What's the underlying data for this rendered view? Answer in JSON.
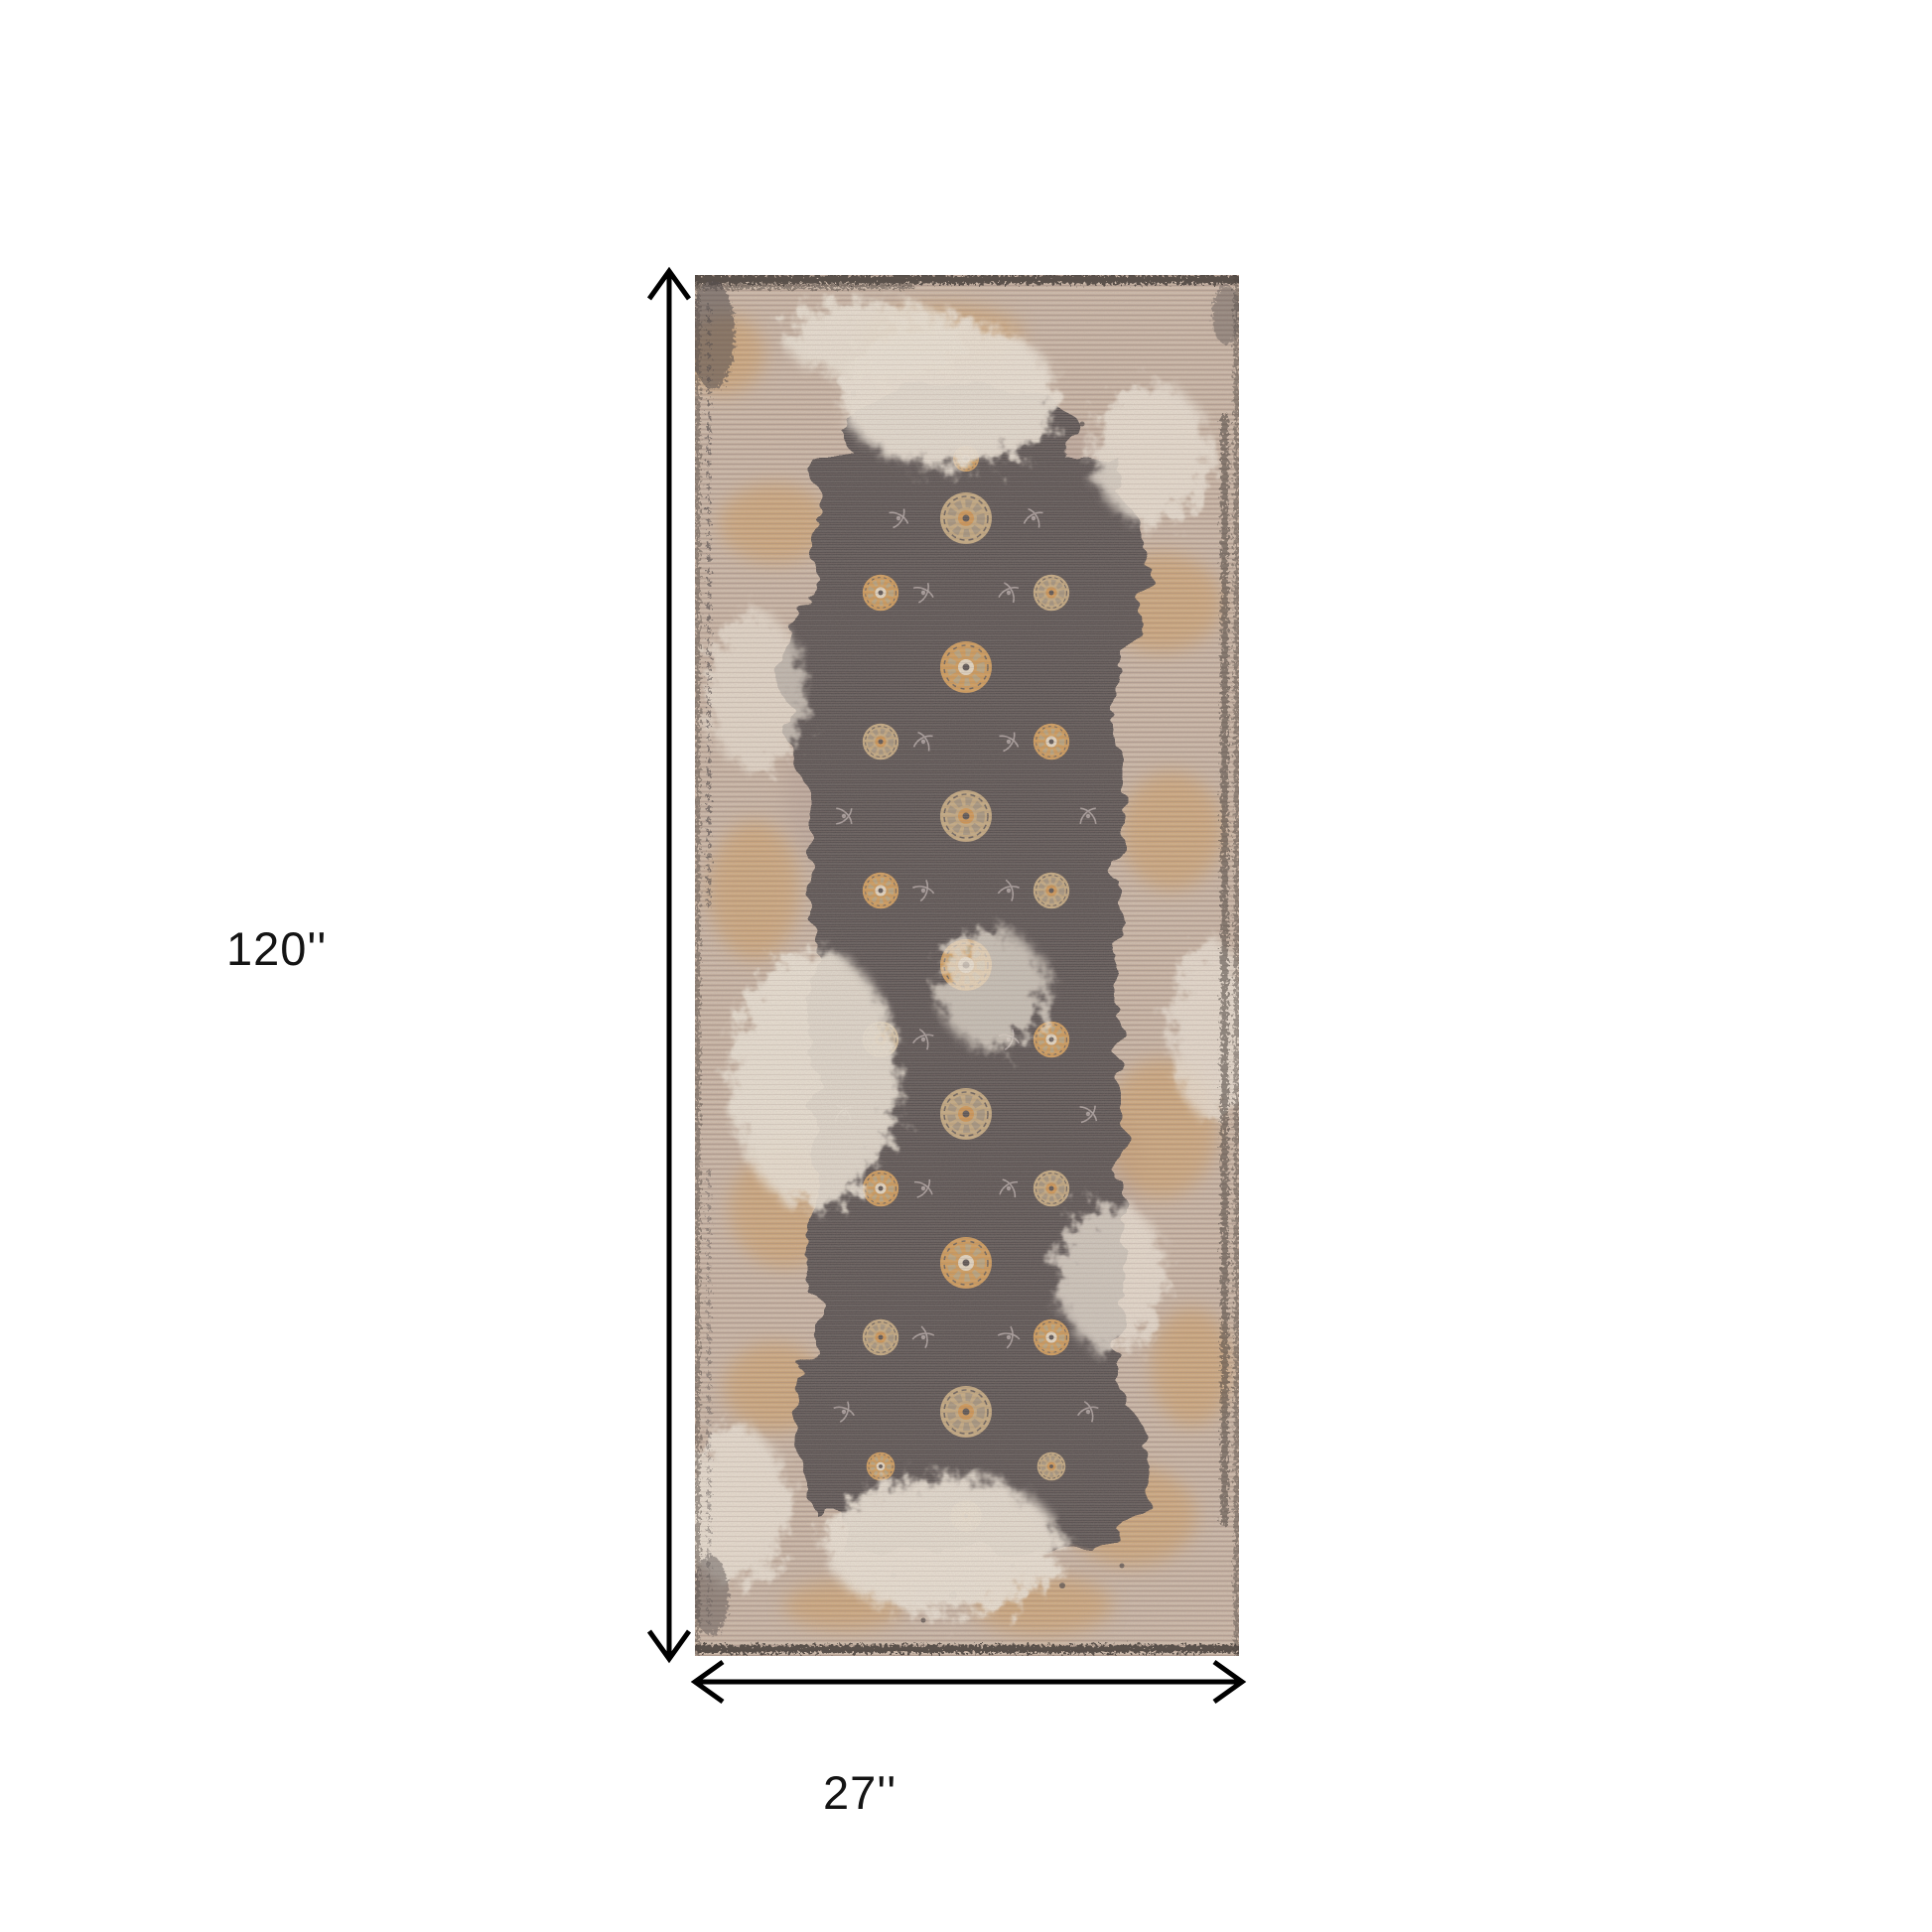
{
  "figure": {
    "type": "product-dimension-diagram",
    "product": "Distressed vintage oriental runner rug",
    "height_label": "120''",
    "width_label": "27''",
    "height_value_inches": 120,
    "width_value_inches": 27
  },
  "annotation": {
    "line_color": "#000000",
    "label_color": "#141414"
  },
  "rug_palette": {
    "field_beige": "#c6b1a0",
    "striation_dark": "#a6938a",
    "striation_light": "#e6d9cb",
    "rust_orange": "#d09a58",
    "worn_cream": "#ece4d7",
    "medallion_charcoal": "#57504f",
    "rosette_tan": "#c3a87f",
    "rosette_orange": "#cf9552",
    "vine_gray": "#b5aaa9",
    "border_dark": "#4f4743"
  },
  "canvas": {
    "background": "#ffffff"
  }
}
